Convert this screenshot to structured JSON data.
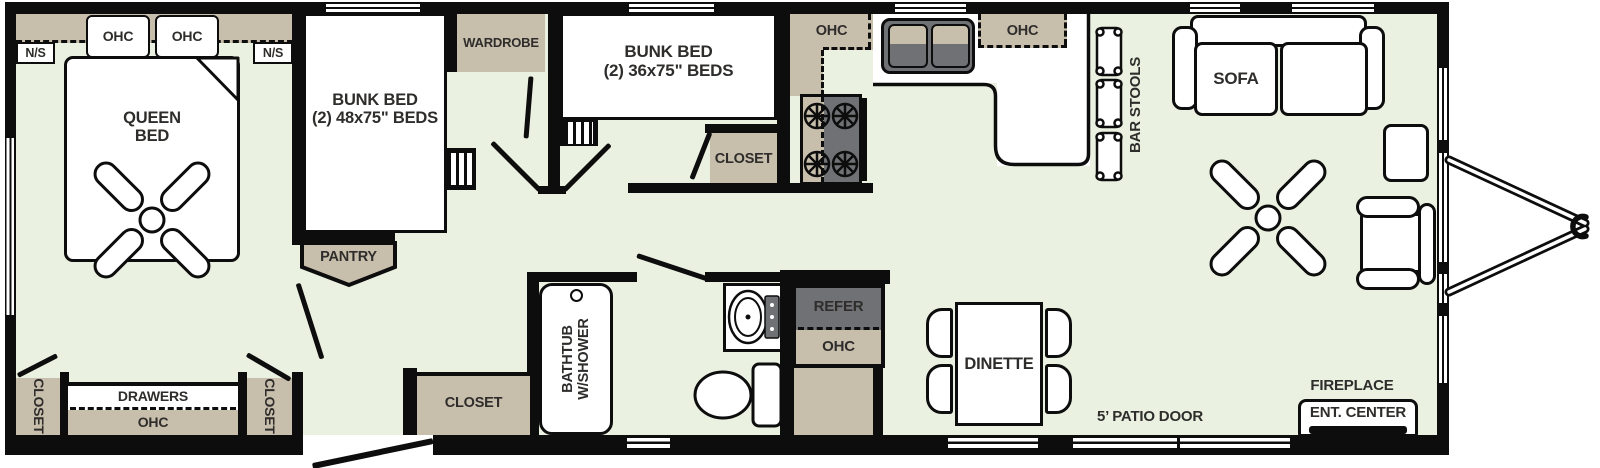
{
  "colors": {
    "floor": "#eaf1e1",
    "wall": "#0d0d0d",
    "cabinet": "#c8beac",
    "appliance": "#6f7174",
    "label": "#2e2d2b"
  },
  "bedroom": {
    "ohc_left": "OHC",
    "ohc_right": "OHC",
    "ns_left": "N/S",
    "ns_right": "N/S",
    "bed": "QUEEN\nBED",
    "closet_left": "CLOSET",
    "closet_right": "CLOSET",
    "drawers": "DRAWERS",
    "ohc_bottom": "OHC"
  },
  "bunk48": {
    "bed": "BUNK BED\n(2) 48x75\" BEDS",
    "pantry": "PANTRY"
  },
  "bunk36": {
    "bed": "BUNK BED\n(2) 36x75\" BEDS",
    "wardrobe": "WARDROBE",
    "closet": "CLOSET"
  },
  "kitchen": {
    "ohc_left": "OHC",
    "ohc_right": "OHC",
    "bar_stools": "BAR STOOLS"
  },
  "bath": {
    "tub": "BATHTUB\nW/SHOWER",
    "closet": "CLOSET"
  },
  "galley": {
    "refer": "REFER",
    "ohc": "OHC"
  },
  "living": {
    "dinette": "DINETTE",
    "sofa": "SOFA",
    "fireplace": "FIREPLACE",
    "ent_center": "ENT. CENTER",
    "patio_door": "5’ PATIO DOOR"
  }
}
